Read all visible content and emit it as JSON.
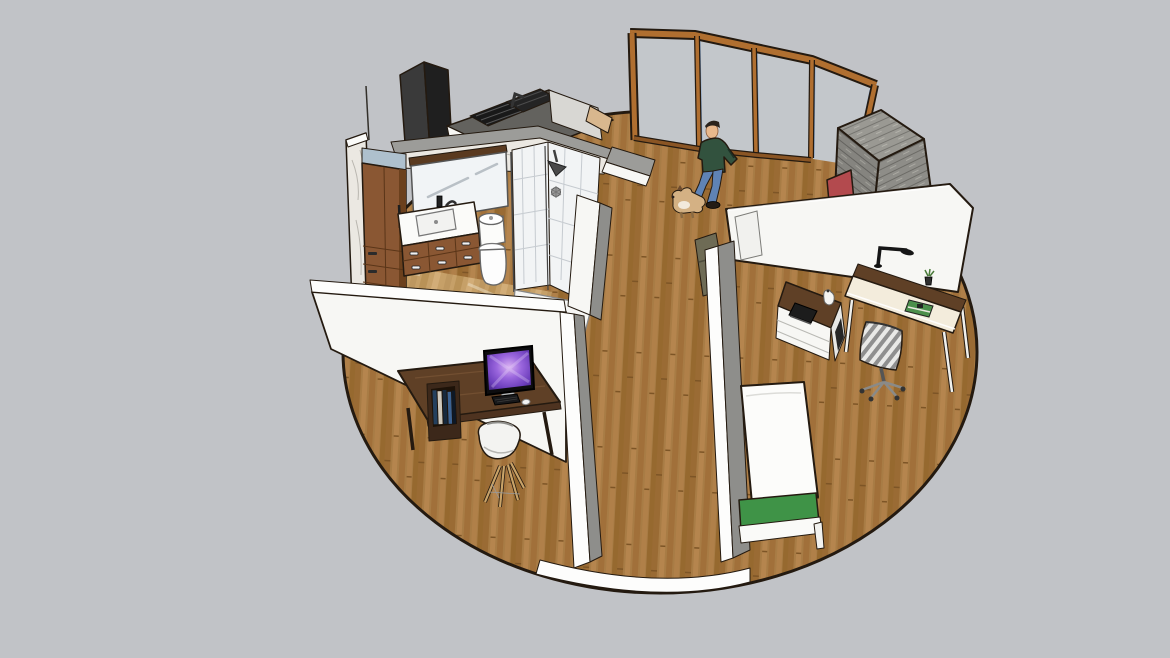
{
  "scene": {
    "type": "3d-architectural-model-viewport",
    "view": "aerial-perspective",
    "floor_shape": "circle",
    "rooms": [
      "bathroom",
      "kitchen",
      "office-nook-left",
      "office-right",
      "bedroom-nook",
      "entry-with-curved-glazing"
    ]
  },
  "objects": [
    {
      "name": "circular-wood-floor",
      "label": "circular wood plank floor"
    },
    {
      "name": "curved-window-wall",
      "label": "curved wood-framed window wall"
    },
    {
      "name": "brick-chimney",
      "label": "grey brick chimney block"
    },
    {
      "name": "fireplace-red",
      "label": "red fireplace element"
    },
    {
      "name": "kitchen-block",
      "label": "kitchen counter with cooktop and tall black cabinet"
    },
    {
      "name": "bathroom",
      "label": "bathroom with vanity, mirror, toilet and tiled shower"
    },
    {
      "name": "man-figure",
      "label": "standing man in green sweater and jeans"
    },
    {
      "name": "dog",
      "label": "small tan dog"
    },
    {
      "name": "bed",
      "label": "bed with green foot bench"
    },
    {
      "name": "right-desk",
      "label": "desk with task lamp and cabinet"
    },
    {
      "name": "office-chair",
      "label": "striped swivel office chair"
    },
    {
      "name": "left-desk",
      "label": "walnut desk with iMac and book shelf"
    },
    {
      "name": "eames-chair",
      "label": "white shell chair with wood legs"
    },
    {
      "name": "partition-walls",
      "label": "white partition walls"
    }
  ],
  "colors": {
    "bg": "#c1c3c7",
    "outline": "#241a10",
    "floorWood": "#a87c45",
    "bathFloor": "#c6a068",
    "wallWhite": "#f7f7f4",
    "wallBright": "#fdfdfc",
    "wallGray": "#8e8e8b",
    "wallTopGray": "#9c9c99",
    "woodFrame": "#b06f30",
    "woodFrameDark": "#8a5524",
    "glass": "#c3c7cb",
    "glassBlue": "#7fa3cf",
    "brick": "#8e8d88",
    "brickLight": "#a7a69f",
    "fireRed": "#b34a4e",
    "marble": "#ebe8e2",
    "steelBlue": "#aec0cd",
    "cabinetWood": "#8a5733",
    "cabinetWoodDark": "#6b401d",
    "deskWalnut": "#5f4026",
    "creamDesk": "#f3ecdc",
    "tanWood": "#d8b78e",
    "tile": "#f2f4f5",
    "tileLine": "#c6cbd0",
    "sweater": "#32523e",
    "jeans": "#5f83b5",
    "skin": "#e8b88c",
    "hair": "#2a231c",
    "shoe": "#241c15",
    "dogTan": "#d4b184",
    "bedGreen": "#3f9347",
    "lamp": "#161616",
    "olive": "#6e6b55",
    "chairShell": "#f3f3f1",
    "chairLeg": "#c9a368",
    "counterGray": "#63625e",
    "applianceBlack": "#1f1f1f",
    "applianceGray": "#3a3a3a"
  }
}
